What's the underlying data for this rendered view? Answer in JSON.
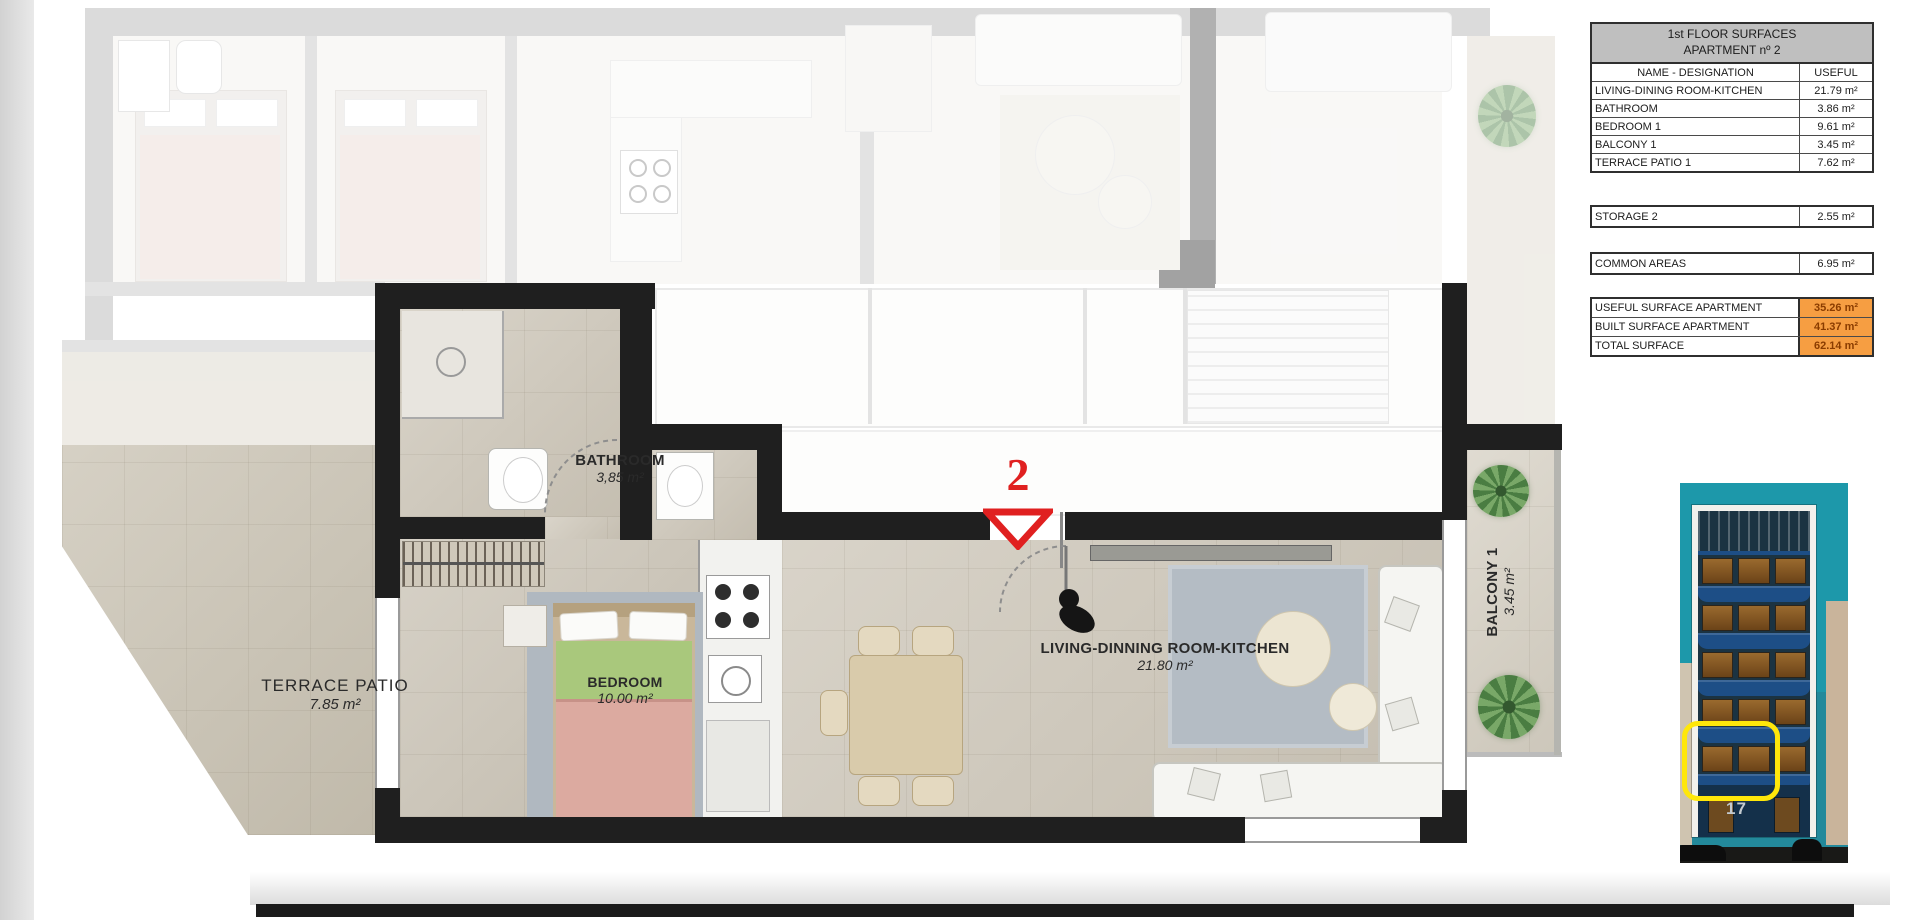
{
  "plan": {
    "apartment_marker": "2",
    "rooms": {
      "bathroom": {
        "name": "BATHROOM",
        "area": "3,85 m²"
      },
      "bedroom": {
        "name": "BEDROOM",
        "area": "10.00 m²"
      },
      "living": {
        "name": "LIVING-DINNING ROOM-KITCHEN",
        "area": "21.80 m²"
      },
      "terrace": {
        "name": "TERRACE  PATIO",
        "area": "7.85 m²"
      },
      "balcony": {
        "name": "BALCONY 1",
        "area": "3.45 m²"
      }
    }
  },
  "surfaces_table": {
    "title_line1": "1st FLOOR SURFACES",
    "title_line2": "APARTMENT nº 2",
    "columns": {
      "name": "NAME - DESIGNATION",
      "useful": "USEFUL"
    },
    "rows": [
      {
        "name": "LIVING-DINING ROOM-KITCHEN",
        "value": "21.79 m²"
      },
      {
        "name": "BATHROOM",
        "value": "3.86 m²"
      },
      {
        "name": "BEDROOM 1",
        "value": "9.61 m²"
      },
      {
        "name": "BALCONY 1",
        "value": "3.45 m²"
      },
      {
        "name": "TERRACE PATIO 1",
        "value": "7.62 m²"
      }
    ],
    "storage": {
      "name": "STORAGE 2",
      "value": "2.55 m²"
    },
    "common": {
      "name": "COMMON AREAS",
      "value": "6.95 m²"
    },
    "totals": [
      {
        "name": "USEFUL SURFACE APARTMENT",
        "value": "35.26 m²"
      },
      {
        "name": "BUILT SURFACE APARTMENT",
        "value": "41.37 m²"
      },
      {
        "name": "TOTAL SURFACE",
        "value": "62.14 m²"
      }
    ]
  },
  "building_photo": {
    "street_number": "17"
  },
  "colors": {
    "accent_orange": "#F79646",
    "marker_red": "#E02020",
    "highlight_yellow": "#FFE70A",
    "sky_teal": "#1D98AA",
    "balcony_blue": "#1D4E86",
    "table_header_gray": "#BFBFBF"
  }
}
